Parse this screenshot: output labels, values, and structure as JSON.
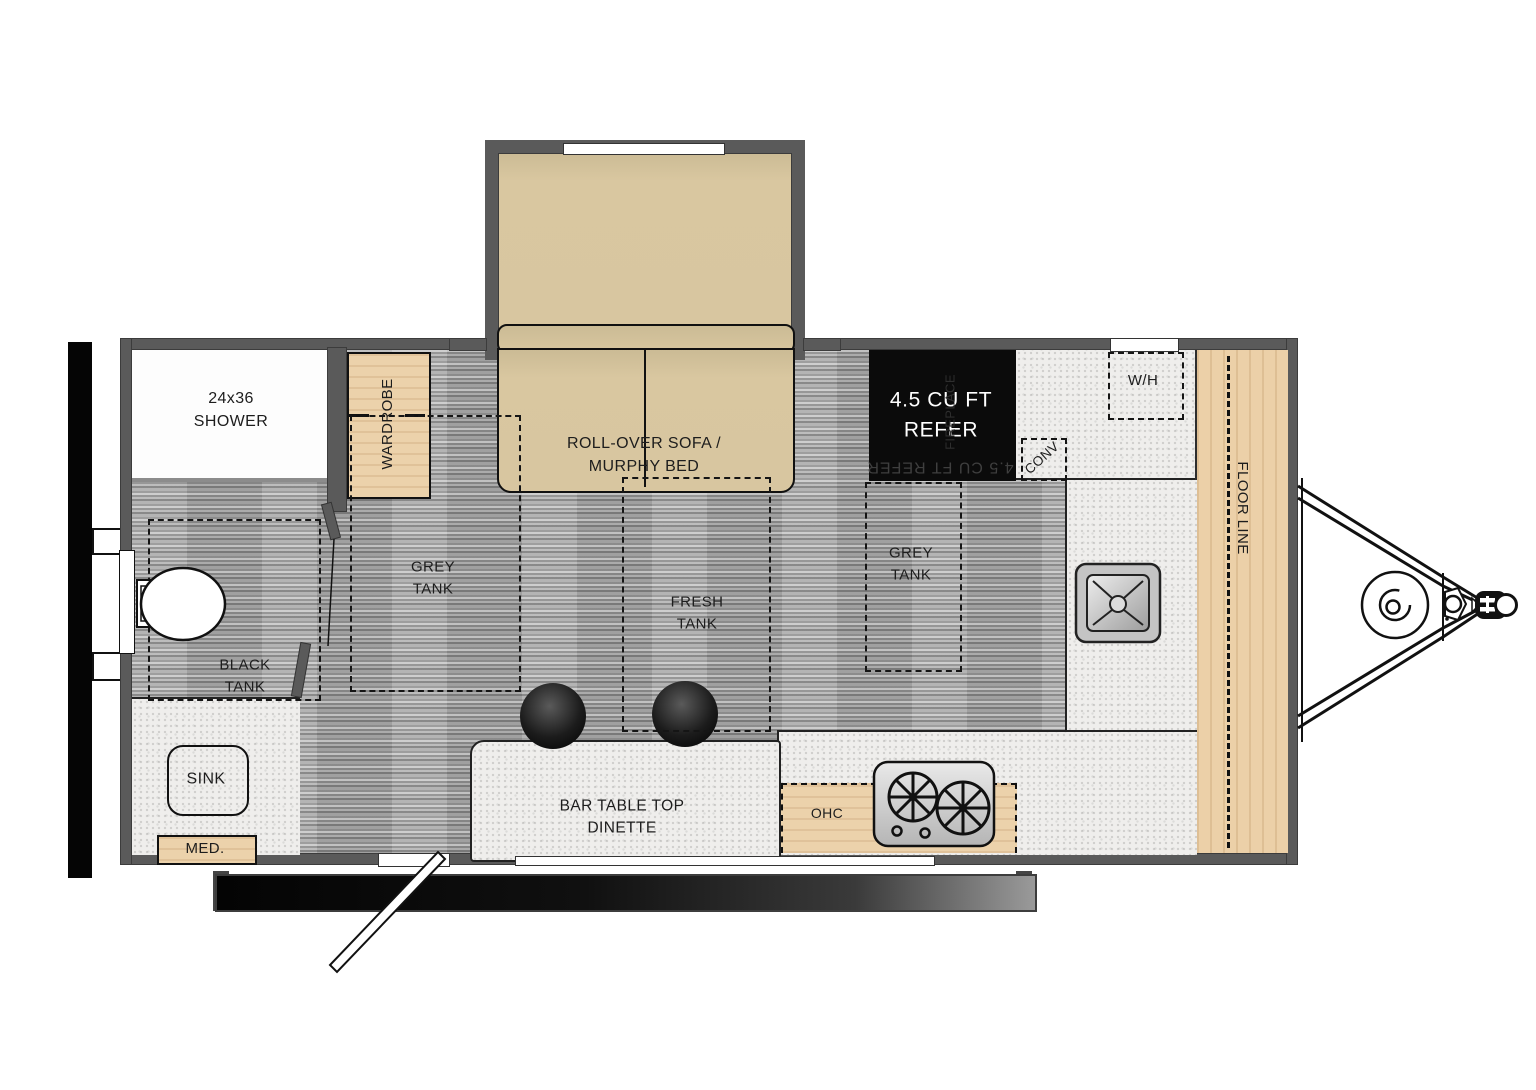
{
  "title": "travel-trailer-floorplan",
  "labels": {
    "shower": {
      "line1": "24x36",
      "line2": "SHOWER"
    },
    "wardrobe": "WARDROBE",
    "sofa": {
      "line1": "ROLL-OVER SOFA /",
      "line2": "MURPHY BED"
    },
    "refrigerator": {
      "line1": "4.5 CU FT",
      "line2": "REFER",
      "ghost": "4.5 CU FT REFER",
      "side_vertical": "FIREPLACE"
    },
    "water_heater": "W/H",
    "convection": "CONV",
    "floor_line": "FLOOR LINE",
    "tanks": {
      "black": {
        "line1": "BLACK",
        "line2": "TANK"
      },
      "grey1": {
        "line1": "GREY",
        "line2": "TANK"
      },
      "fresh": {
        "line1": "FRESH",
        "line2": "TANK"
      },
      "grey2": {
        "line1": "GREY",
        "line2": "TANK"
      }
    },
    "bath_sink": "SINK",
    "med_cabinet": "MED.",
    "dinette": {
      "line1": "BAR TABLE TOP",
      "line2": "DINETTE"
    },
    "ohc": "OHC"
  },
  "colors": {
    "wall_grey": "#5a5a5a",
    "floor_grey": "#a7a7a7",
    "counter_speckle": "#efeeec",
    "cabinet_tan": "#ecd2ab",
    "sofa_tan": "#d8c6a0",
    "refer_black": "#0b0b0b",
    "line_black": "#151515",
    "text_dark": "#1d1d1d",
    "text_white": "#ffffff"
  }
}
